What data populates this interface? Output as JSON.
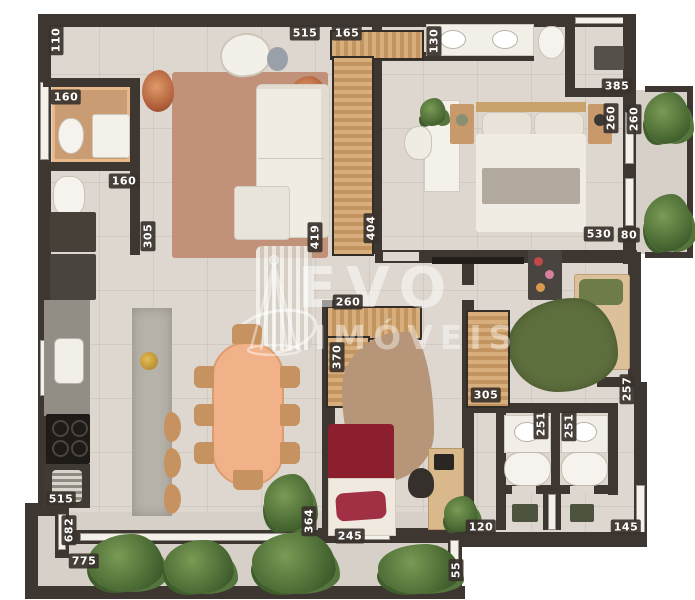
{
  "plan": {
    "watermark": {
      "line1": "EVO",
      "line2": "IMÓVEIS"
    },
    "palette": {
      "wall": "#3e3731",
      "floor": "#ded7cf",
      "terrace_floor": "#d6d0c8",
      "closet_wood": "#d7ae7c",
      "living_rug": "#c29179",
      "dining_table": "#f2b289",
      "kitchen_island": "#b6b3aa",
      "master_duvet": "#f0ebe3",
      "bed_red": "#8c1f2e",
      "green_rug": "#5e6f3e",
      "tan_rug": "#b69578",
      "plant_green": "#4a6a34",
      "label_text": "#ffffff",
      "label_chip": "#3a322c"
    },
    "dimensions": [
      {
        "text": "110",
        "x": 56,
        "y": 40,
        "vertical": true
      },
      {
        "text": "160",
        "x": 66,
        "y": 97,
        "vertical": false
      },
      {
        "text": "160",
        "x": 124,
        "y": 181,
        "vertical": false
      },
      {
        "text": "305",
        "x": 148,
        "y": 236,
        "vertical": true
      },
      {
        "text": "515",
        "x": 305,
        "y": 33,
        "vertical": false
      },
      {
        "text": "165",
        "x": 347,
        "y": 33,
        "vertical": false
      },
      {
        "text": "130",
        "x": 434,
        "y": 41,
        "vertical": true
      },
      {
        "text": "385",
        "x": 617,
        "y": 86,
        "vertical": false
      },
      {
        "text": "260",
        "x": 611,
        "y": 118,
        "vertical": true
      },
      {
        "text": "260",
        "x": 634,
        "y": 119,
        "vertical": true
      },
      {
        "text": "530",
        "x": 599,
        "y": 234,
        "vertical": false
      },
      {
        "text": "80",
        "x": 629,
        "y": 235,
        "vertical": false
      },
      {
        "text": "419",
        "x": 315,
        "y": 237,
        "vertical": true
      },
      {
        "text": "404",
        "x": 371,
        "y": 228,
        "vertical": true
      },
      {
        "text": "260",
        "x": 348,
        "y": 302,
        "vertical": false
      },
      {
        "text": "370",
        "x": 337,
        "y": 357,
        "vertical": true
      },
      {
        "text": "305",
        "x": 486,
        "y": 395,
        "vertical": false
      },
      {
        "text": "257",
        "x": 627,
        "y": 389,
        "vertical": true
      },
      {
        "text": "251",
        "x": 541,
        "y": 424,
        "vertical": true
      },
      {
        "text": "251",
        "x": 569,
        "y": 426,
        "vertical": true
      },
      {
        "text": "245",
        "x": 350,
        "y": 536,
        "vertical": false
      },
      {
        "text": "120",
        "x": 481,
        "y": 527,
        "vertical": false
      },
      {
        "text": "145",
        "x": 626,
        "y": 527,
        "vertical": false
      },
      {
        "text": "55",
        "x": 456,
        "y": 570,
        "vertical": true
      },
      {
        "text": "515",
        "x": 61,
        "y": 499,
        "vertical": false
      },
      {
        "text": "682",
        "x": 69,
        "y": 530,
        "vertical": true
      },
      {
        "text": "775",
        "x": 84,
        "y": 561,
        "vertical": false
      },
      {
        "text": "364",
        "x": 309,
        "y": 521,
        "vertical": true
      }
    ]
  }
}
